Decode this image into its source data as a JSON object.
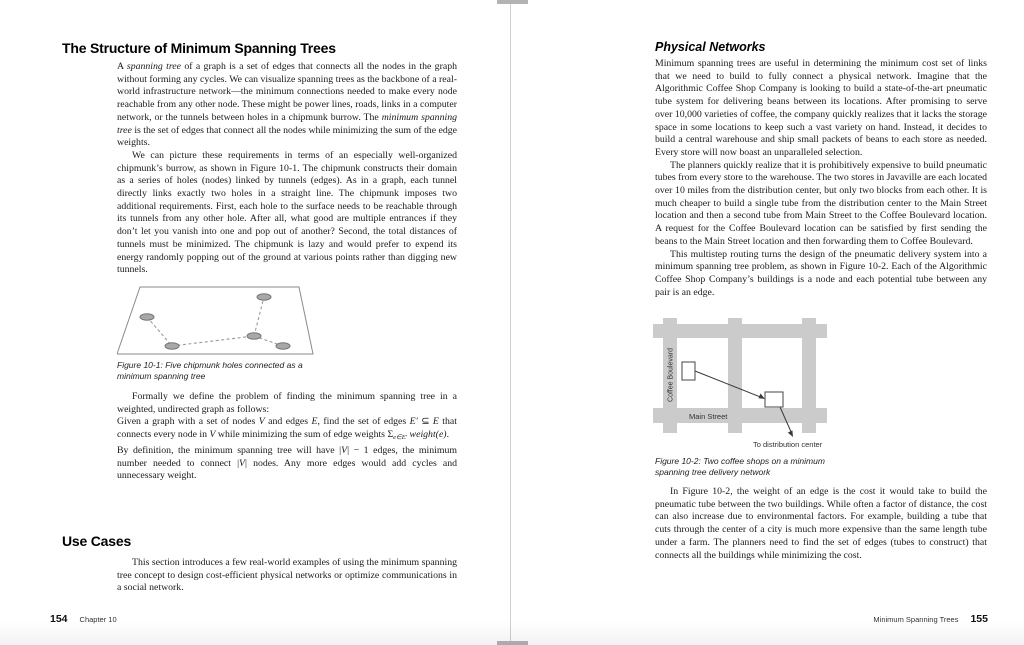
{
  "book": {
    "left_page": {
      "heading": "The Structure of Minimum Spanning Trees",
      "para1": {
        "t1": "A ",
        "em1": "spanning tree",
        "t2": " of a graph is a set of edges that connects all the nodes in the graph without forming any cycles. We can visualize spanning trees as the backbone of a real-world infrastructure network—the minimum connections needed to make every node reachable from any other node. These might be power lines, roads, links in a computer network, or the tunnels between holes in a chipmunk burrow. The ",
        "em2": "minimum spanning tree",
        "t3": " is the set of edges that connect all the nodes while minimizing the sum of the edge weights."
      },
      "para2": "We can picture these requirements in terms of an especially well-organized chipmunk’s burrow, as shown in Figure 10-1. The chipmunk constructs their domain as a series of holes (nodes) linked by tunnels (edges). As in a graph, each tunnel directly links exactly two holes in a straight line. The chipmunk imposes two additional requirements. First, each hole to the surface needs to be reachable through its tunnels from any other hole. After all, what good are multiple entrances if they don’t let you vanish into one and pop out of another? Second, the total distances of tunnels must be minimized. The chipmunk is lazy and would prefer to expend its energy randomly popping out of the ground at various points rather than digging new tunnels.",
      "figure1": {
        "caption": "Figure 10-1: Five chipmunk holes connected as a minimum spanning tree"
      },
      "para3": "Formally we define the problem of finding the minimum spanning tree in a weighted, undirected graph as follows:",
      "quote": {
        "t1": "Given a graph with a set of nodes ",
        "v1": "V",
        "t2": " and edges ",
        "e1": "E",
        "t3": ", find the set of edges ",
        "e2": "E′",
        "t4": " ⊆ ",
        "e3": "E",
        "t5": " that connects every node in ",
        "v2": "V",
        "t6": " while minimizing the sum of edge weights ",
        "sigma": "Σ",
        "sub": "e∈E′",
        "weight": " weight(e)",
        "t7": "."
      },
      "para4": {
        "t1": "By definition, the minimum spanning tree will have |",
        "v1": "V",
        "t2": "| − 1 edges, the minimum number needed to connect |",
        "v2": "V",
        "t3": "| nodes. Any more edges would add cycles and unnecessary weight."
      },
      "heading2": "Use Cases",
      "para5": "This section introduces a few real-world examples of using the minimum spanning tree concept to design cost-efficient physical networks or optimize communications in a social network.",
      "footer": {
        "page_number": "154",
        "label": "Chapter 10"
      }
    },
    "right_page": {
      "heading": "Physical Networks",
      "para1": "Minimum spanning trees are useful in determining the minimum cost set of links that we need to build to fully connect a physical network. Imagine that the Algorithmic Coffee Shop Company is looking to build a state-of-the-art pneumatic tube system for delivering beans between its locations. After promising to serve over 10,000 varieties of coffee, the company quickly realizes that it lacks the storage space in some locations to keep such a vast variety on hand. Instead, it decides to build a central warehouse and ship small packets of beans to each store as needed. Every store will now boast an unparalleled selection.",
      "para2": "The planners quickly realize that it is prohibitively expensive to build pneumatic tubes from every store to the warehouse. The two stores in Javaville are each located over 10 miles from the distribution center, but only two blocks from each other. It is much cheaper to build a single tube from the distribution center to the Main Street location and then a second tube from Main Street to the Coffee Boulevard location. A request for the Coffee Boulevard location can be satisfied by first sending the beans to the Main Street location and then forwarding them to Coffee Boulevard.",
      "para3": "This multistep routing turns the design of the pneumatic delivery system into a minimum spanning tree problem, as shown in Figure 10-2. Each of the Algorithmic Coffee Shop Company’s buildings is a node and each potential tube between any pair is an edge.",
      "figure2": {
        "labels": {
          "street_vertical": "Coffee Boulevard",
          "street_horizontal": "Main Street",
          "arrow": "To distribution center"
        },
        "caption": "Figure 10-2: Two coffee shops on a minimum spanning tree delivery network"
      },
      "para4": "In Figure 10-2, the weight of an edge is the cost it would take to build the pneumatic tube between the two buildings. While often a factor of distance, the cost can also increase due to environmental factors. For example, building a tube that cuts through the center of a city is much more expensive than the same length tube under a farm. The planners need to find the set of edges (tubes to construct) that connects all the buildings while minimizing the cost.",
      "footer": {
        "label": "Minimum Spanning Trees",
        "page_number": "155"
      }
    },
    "colors": {
      "street_gray": "#cbcbcb",
      "node_gray": "#a8a8a8",
      "spine_gray": "#cfcfcf"
    }
  }
}
